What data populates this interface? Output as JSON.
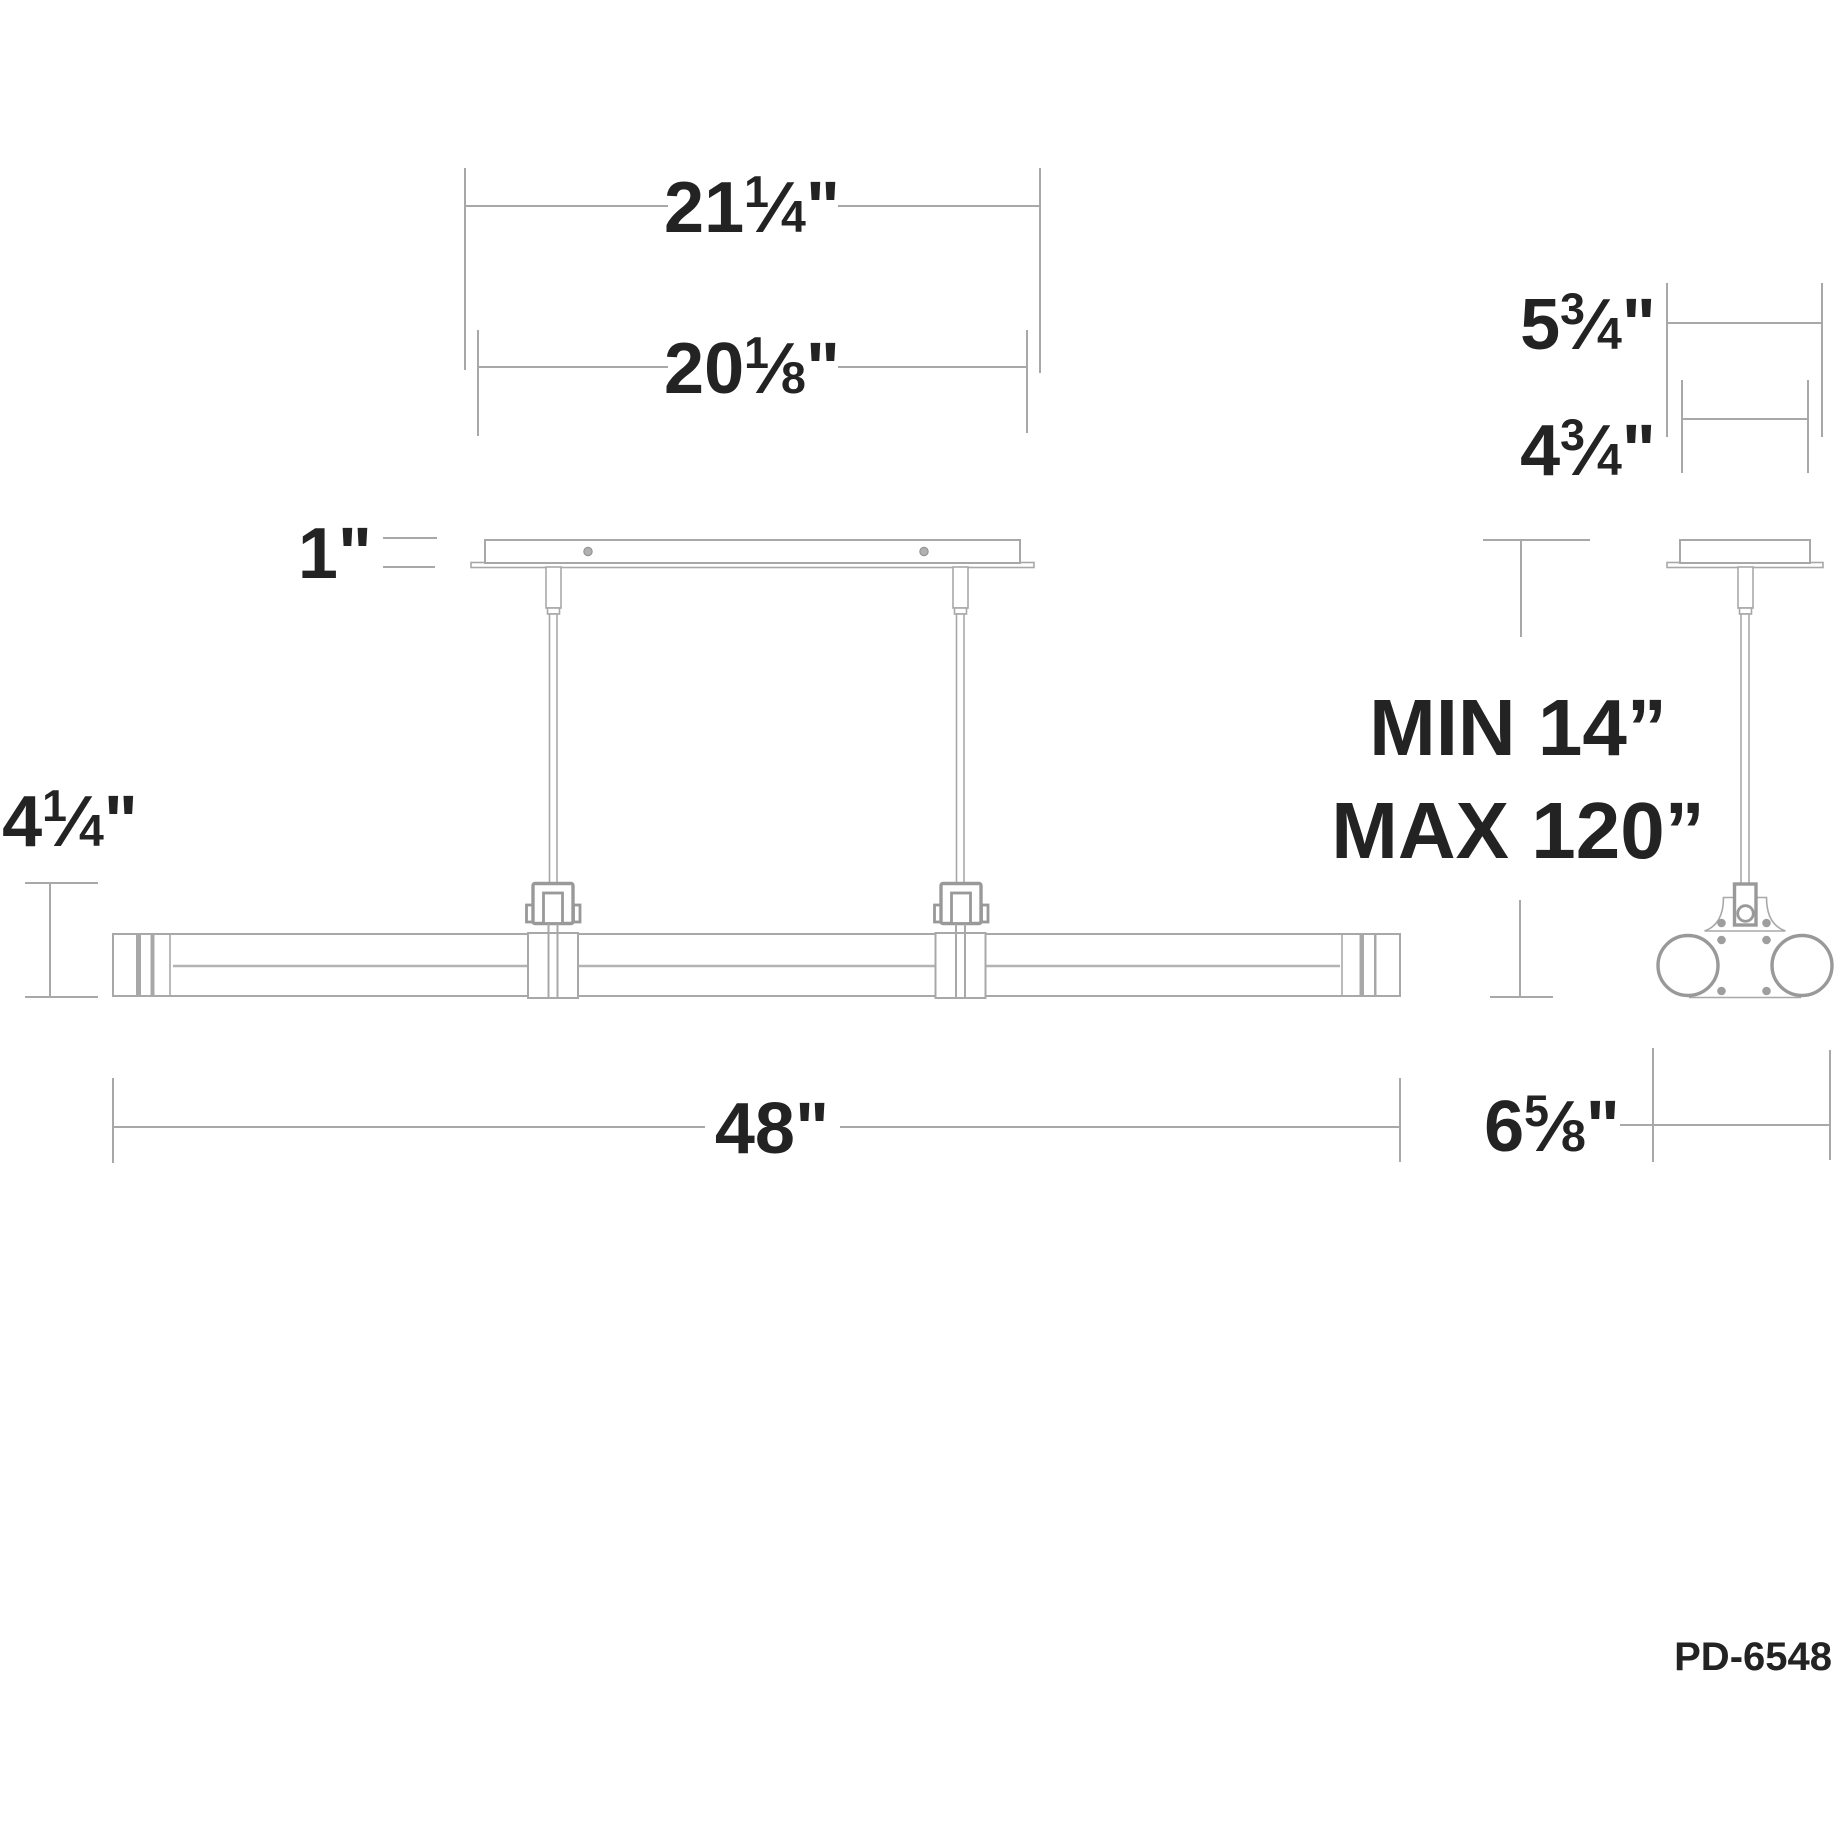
{
  "colors": {
    "line": "#a8a8a8",
    "line_dark": "#999999",
    "text": "#232323",
    "background": "#ffffff"
  },
  "product_code": "PD-6548",
  "dimensions": {
    "canopy_overall_width": {
      "text": "21¼\"",
      "whole": "21",
      "num": "1",
      "den": "4",
      "unit": "\""
    },
    "canopy_body_width": {
      "text": "20⅛\"",
      "whole": "20",
      "num": "1",
      "den": "8",
      "unit": "\""
    },
    "canopy_height": {
      "text": "1\"",
      "whole": "1",
      "unit": "\""
    },
    "fixture_height": {
      "text": "4¼\"",
      "whole": "4",
      "num": "1",
      "den": "4",
      "unit": "\""
    },
    "fixture_length": {
      "text": "48\"",
      "whole": "48",
      "unit": "\""
    },
    "side_flange_width": {
      "text": "5¾\"",
      "whole": "5",
      "num": "3",
      "den": "4",
      "unit": "\""
    },
    "side_canopy_width": {
      "text": "4¾\"",
      "whole": "4",
      "num": "3",
      "den": "4",
      "unit": "\""
    },
    "suspension_min": "MIN 14”",
    "suspension_max": "MAX 120”",
    "side_body_width": {
      "text": "6⅝\"",
      "whole": "6",
      "num": "5",
      "den": "8",
      "unit": "\""
    }
  }
}
